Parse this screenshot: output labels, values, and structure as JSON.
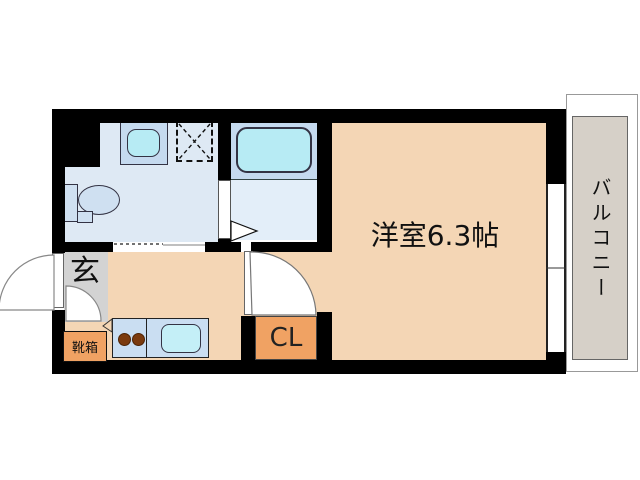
{
  "floorplan": {
    "type": "apartment-floor-plan",
    "rooms": {
      "main_room": {
        "label": "洋室6.3帖"
      },
      "balcony": {
        "label": "バルコニー"
      },
      "entrance": {
        "label": "玄"
      },
      "shoe_box": {
        "label": "靴箱"
      },
      "closet": {
        "label": "CL"
      }
    },
    "fixtures": [
      "toilet",
      "washbasin",
      "washer-pan",
      "bathtub",
      "kitchen-stove-2-burner",
      "kitchen-sink",
      "front-door-swing",
      "room-door-swing",
      "bath-folding-door",
      "sliding-door",
      "balcony-window"
    ],
    "colors": {
      "wall": "#000000",
      "main_room_floor": "#f4d6b5",
      "washroom_floor": "#dee9f4",
      "bath_floor": "#e3eef9",
      "bath_tub_zone": "#c5daef",
      "water_fixture": "#b7ebf4",
      "kitchen_counter": "#cadef2",
      "entrance_floor": "#d3d3d3",
      "storage_orange": "#f0a263",
      "balcony_floor": "#d6d0c8",
      "burner": "#7b3a0e",
      "text": "#111111"
    }
  }
}
